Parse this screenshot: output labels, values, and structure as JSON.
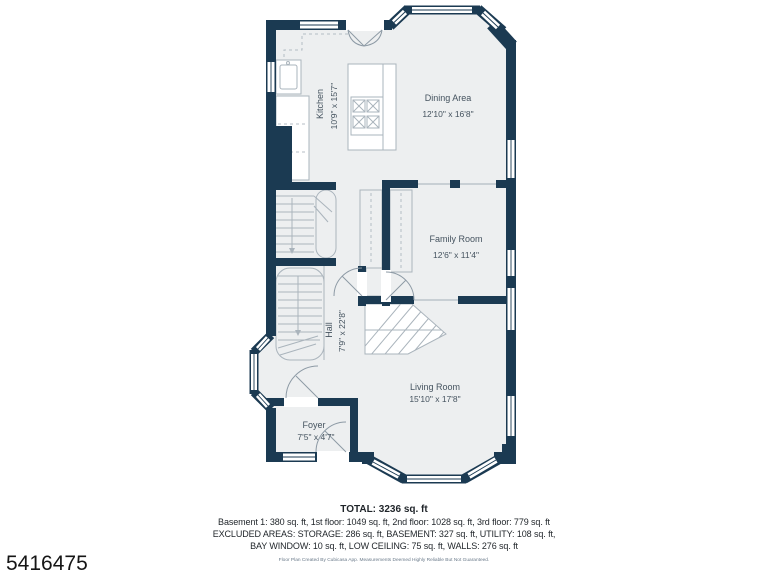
{
  "plan_id": "5416475",
  "rooms": {
    "kitchen": {
      "name": "Kitchen",
      "dims": "10'9\" x 15'7\""
    },
    "dining": {
      "name": "Dining Area",
      "dims": "12'10\" x 16'8\""
    },
    "family": {
      "name": "Family Room",
      "dims": "12'6\" x 11'4\""
    },
    "hall": {
      "name": "Hall",
      "dims": "7'9\" x 22'8\""
    },
    "living": {
      "name": "Living Room",
      "dims": "15'10\" x 17'8\""
    },
    "foyer": {
      "name": "Foyer",
      "dims": "7'5\" x 4'7\""
    }
  },
  "summary": {
    "total": "TOTAL: 3236 sq. ft",
    "line1": "Basement 1: 380 sq. ft, 1st floor: 1049 sq. ft, 2nd floor: 1028 sq. ft, 3rd floor: 779 sq. ft",
    "line2": "EXCLUDED AREAS: STORAGE: 286 sq. ft, BASEMENT: 327 sq. ft, UTILITY: 108 sq. ft,",
    "line3": "BAY WINDOW: 10 sq. ft, LOW CEILING: 75 sq. ft, WALLS: 276 sq. ft"
  },
  "disclaimer": "Floor Plan Created By Cubicasa App. Measurements Deemed Highly Reliable But Not Guaranteed.",
  "colors": {
    "wall": "#1b3a52",
    "floor": "#edeff0",
    "line": "#aab4bc",
    "label": "#45535f"
  }
}
